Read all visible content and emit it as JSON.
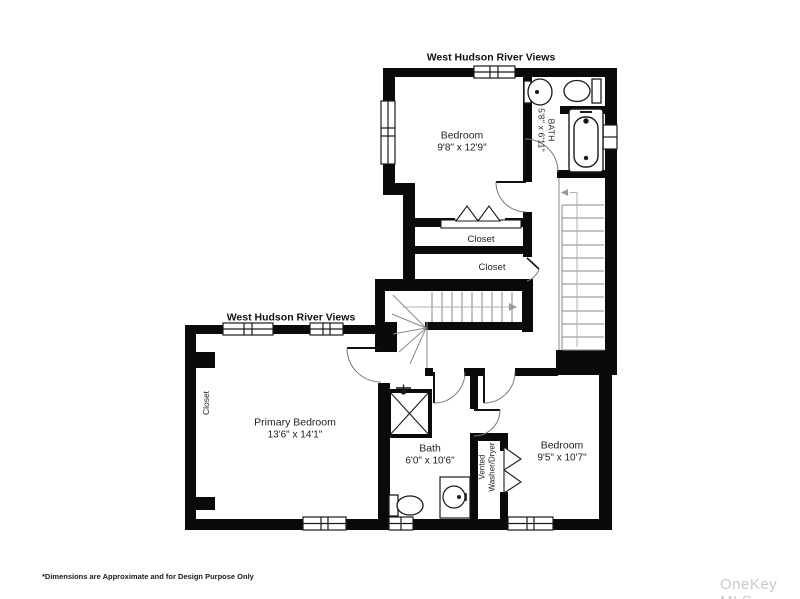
{
  "title_top": "West Hudson River Views",
  "title_left": "West Hudson River Views",
  "rooms": {
    "bedroom_top": {
      "name": "Bedroom",
      "dims": "9'8\" x 12'9\""
    },
    "bath_top": {
      "name": "BATH",
      "dims": "5'8\" x 6'11\""
    },
    "closet_1": {
      "name": "Closet"
    },
    "closet_2": {
      "name": "Closet"
    },
    "primary_bedroom": {
      "name": "Primary Bedroom",
      "dims": "13'6\" x 14'1\""
    },
    "primary_closet": {
      "name": "Closet"
    },
    "bath_lower": {
      "name": "Bath",
      "dims": "6'0\" x 10'6\""
    },
    "laundry": {
      "line1": "Vented",
      "line2": "Washer/Dryer"
    },
    "bedroom_lower": {
      "name": "Bedroom",
      "dims": "9'5\" x 10'7\""
    }
  },
  "footer": {
    "disclaimer": "*Dimensions are Approximate and for Design Purpose Only",
    "watermark": "OneKey MLS"
  },
  "colors": {
    "wall": "#0a0a0a",
    "stair_line": "#8a8a8a",
    "watermark": "#c9c9c9"
  }
}
